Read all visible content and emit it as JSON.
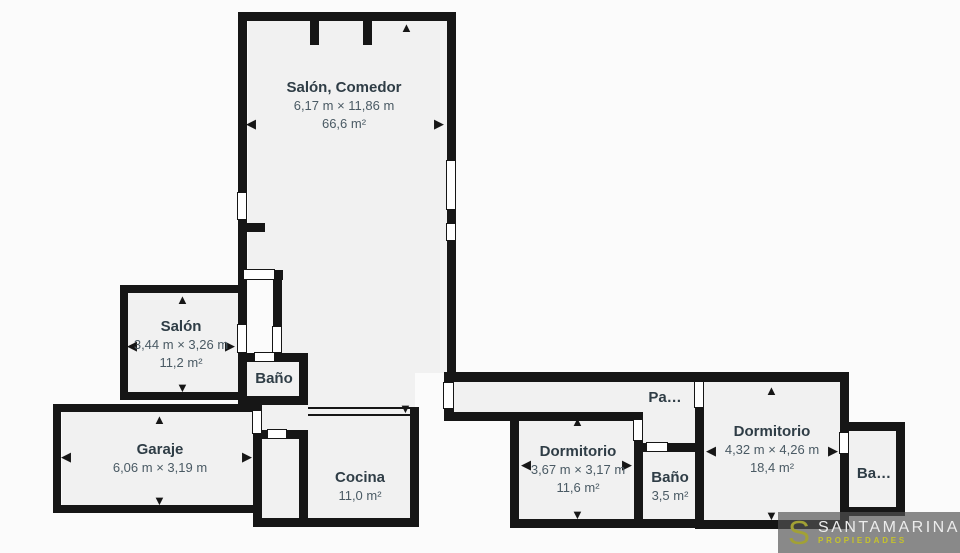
{
  "plan": {
    "rooms": [
      {
        "id": "salon-comedor",
        "name": "Salón, Comedor",
        "dimensions": "6,17 m × 11,86 m",
        "area": "66,6 m²"
      },
      {
        "id": "salon",
        "name": "Salón",
        "dimensions": "3,44 m × 3,26 m",
        "area": "11,2 m²"
      },
      {
        "id": "bano-1",
        "name": "Baño"
      },
      {
        "id": "garaje",
        "name": "Garaje",
        "dimensions": "6,06 m × 3,19 m"
      },
      {
        "id": "cocina",
        "name": "Cocina",
        "area": "11,0 m²"
      },
      {
        "id": "dormitorio-1",
        "name": "Dormitorio",
        "dimensions": "3,67 m × 3,17 m",
        "area": "11,6 m²"
      },
      {
        "id": "bano-2",
        "name": "Baño",
        "area": "3,5 m²"
      },
      {
        "id": "pasillo",
        "name": "Pa…"
      },
      {
        "id": "dormitorio-2",
        "name": "Dormitorio",
        "dimensions": "4,32 m × 4,26 m",
        "area": "18,4 m²"
      },
      {
        "id": "bano-3",
        "name": "Ba…"
      }
    ],
    "colors": {
      "wall": "#161616",
      "room_fill": "#f1f1f1",
      "background": "#fbfbfb",
      "room_name_text": "#2f3d46",
      "dimension_text": "#4a5a64"
    },
    "arrows": {
      "up": "▲",
      "down": "▼",
      "left": "◀",
      "right": "▶"
    }
  },
  "watermark": {
    "logo_letter": "S",
    "brand": "SANTAMARINA",
    "tagline": "PROPIEDADES",
    "logo_color": "#a2a135",
    "brand_color": "#ececec",
    "tagline_color": "#c6c32b"
  }
}
